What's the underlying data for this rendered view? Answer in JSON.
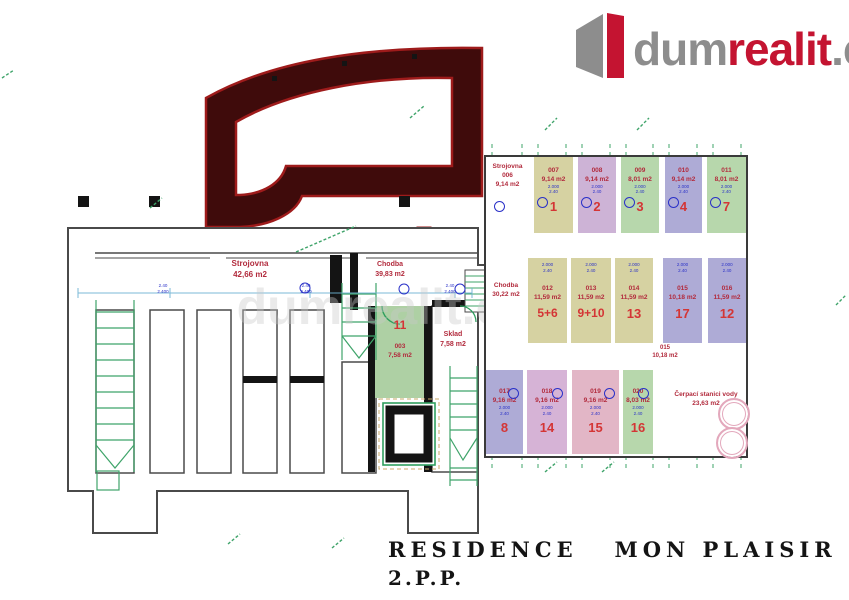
{
  "logo": {
    "dum": "dum",
    "realit": "realit",
    "cz": ".cz"
  },
  "watermark": "dumrealit.cz",
  "title": {
    "line1": "RESIDENCE   MON PLAISIR",
    "line2": "2.P.P."
  },
  "dims": {
    "a": "2.000",
    "b": "2.40",
    "c": "2.400"
  },
  "plan": {
    "strojovna": {
      "name": "Strojovna",
      "area": "42,66 m2"
    },
    "chodba": {
      "name": "Chodba",
      "area": "39,83 m2"
    },
    "room11": {
      "num": "11",
      "code": "003",
      "area": "7,58 m2"
    },
    "sklad": {
      "name": "Sklad",
      "area": "7,58 m2"
    }
  },
  "grid": {
    "strojovna": {
      "name": "Strojovna",
      "code": "006",
      "area": "9,14 m2"
    },
    "chodba": {
      "name": "Chodba",
      "area": "30,22 m2"
    },
    "between": {
      "code": "015",
      "area": "10,18 m2",
      "marker": "1"
    },
    "cerpaci": {
      "name": "Čerpací stanici vody",
      "area": "23,63 m2"
    },
    "top": [
      {
        "code": "007",
        "area": "9,14 m2",
        "num": "1",
        "color": "#d6d2a2"
      },
      {
        "code": "008",
        "area": "9,14 m2",
        "num": "2",
        "color": "#cdb3d6"
      },
      {
        "code": "009",
        "area": "8,01 m2",
        "num": "3",
        "color": "#b7d7ac"
      },
      {
        "code": "010",
        "area": "9,14 m2",
        "num": "4",
        "color": "#aeabd6"
      },
      {
        "code": "011",
        "area": "8,01 m2",
        "num": "7",
        "color": "#b7d7ac"
      }
    ],
    "mid": [
      {
        "code": "012",
        "area": "11,59 m2",
        "num": "5+6",
        "color": "#d6d2a2"
      },
      {
        "code": "013",
        "area": "11,59 m2",
        "num": "9+10",
        "color": "#d6d2a2"
      },
      {
        "code": "014",
        "area": "11,59 m2",
        "num": "13",
        "color": "#d6d2a2"
      },
      {
        "code": "015",
        "area": "10,18 m2",
        "num": "17",
        "color": "#aeabd6"
      },
      {
        "code": "016",
        "area": "11,59 m2",
        "num": "12",
        "color": "#aeabd6"
      }
    ],
    "bottom": [
      {
        "code": "017",
        "area": "9,16 m2",
        "num": "8",
        "color": "#aeabd6"
      },
      {
        "code": "018",
        "area": "9,16 m2",
        "num": "14",
        "color": "#d6b3d6"
      },
      {
        "code": "019",
        "area": "9,16 m2",
        "num": "15",
        "color": "#e2b6c6"
      },
      {
        "code": "020",
        "area": "8,03 m2",
        "num": "16",
        "color": "#b7d7ac"
      }
    ]
  },
  "colors": {
    "accent_red": "#c41431",
    "logo_gray": "#8d8d8d",
    "label_red": "#b22b3d",
    "number_red": "#d43535",
    "dim_blue": "#2a31c8",
    "line_green": "#3fa46a",
    "wall_black": "#141414",
    "plan_line": "#4a4a4a",
    "arch_dark": "#3f0b0b",
    "arch_red": "#9e1b1b",
    "tank_pink": "#e3a8bc"
  }
}
